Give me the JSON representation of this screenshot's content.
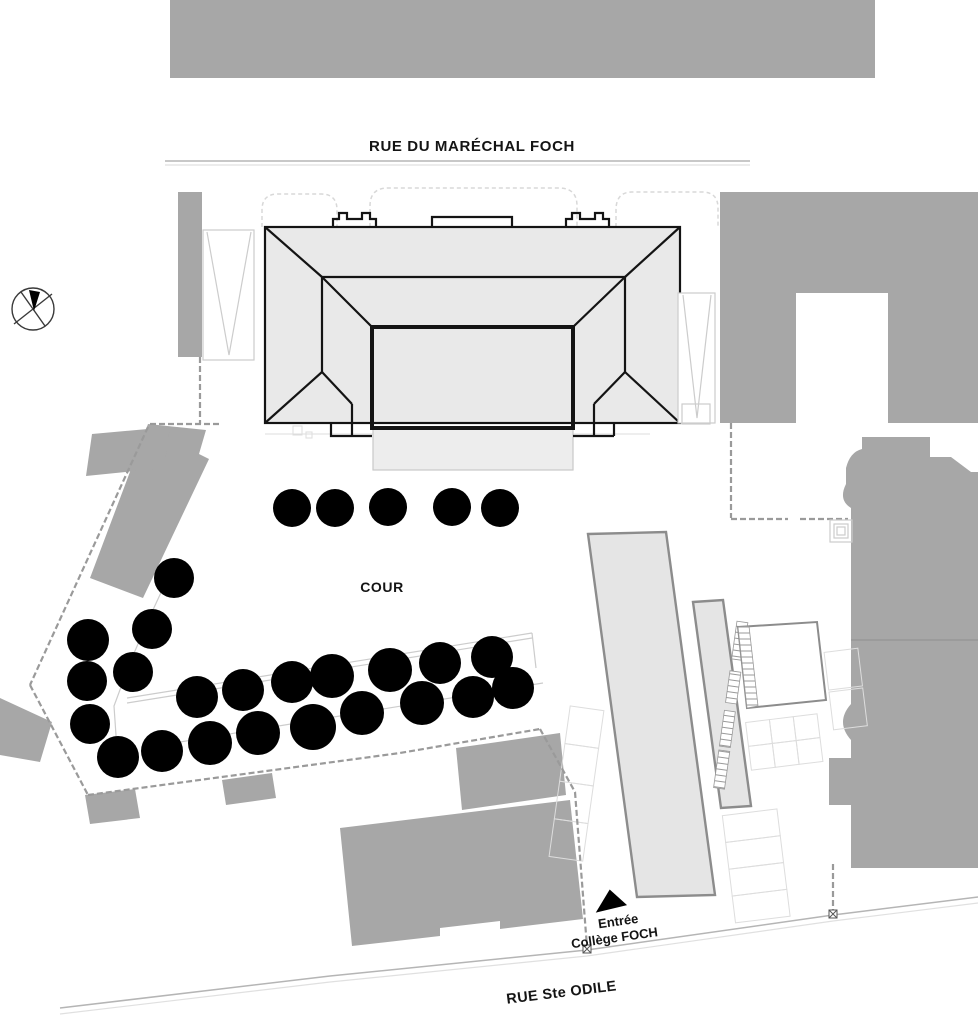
{
  "page": {
    "width": 978,
    "height": 1024,
    "background": "#ffffff"
  },
  "labels": {
    "street_top": "RUE DU MARÉCHAL FOCH",
    "courtyard": "COUR",
    "entrance_line1": "Entrée",
    "entrance_line2": "Collège FOCH",
    "street_bottom": "RUE Ste ODILE"
  },
  "icons": {
    "north_arrow": "compass-north-arrow",
    "entrance_marker": "filled-triangle-up"
  },
  "colors": {
    "bg": "#ffffff",
    "building_solid": "#a7a7a7",
    "roof_fill": "#e9e9e9",
    "roof_line": "#141414",
    "slab_fill": "#e5e5e5",
    "slab_stroke": "#8c8c8c",
    "light_line": "#cccccc",
    "fence_line": "#9a9a9a",
    "street_line": "#b5b5b5",
    "tree_dark": "#1c1c1c",
    "tree_light": "#9c9c9c",
    "label_text": "#141414"
  },
  "trees": [
    {
      "x": 292,
      "y": 508,
      "shade": "light",
      "s": 0.95
    },
    {
      "x": 335,
      "y": 508,
      "shade": "light",
      "s": 0.95
    },
    {
      "x": 388,
      "y": 507,
      "shade": "light",
      "s": 0.95
    },
    {
      "x": 452,
      "y": 507,
      "shade": "light",
      "s": 0.95
    },
    {
      "x": 500,
      "y": 508,
      "shade": "light",
      "s": 0.95
    },
    {
      "x": 174,
      "y": 578,
      "shade": "light",
      "s": 1.0
    },
    {
      "x": 88,
      "y": 640,
      "shade": "dark",
      "s": 1.05
    },
    {
      "x": 152,
      "y": 629,
      "shade": "light",
      "s": 1.0
    },
    {
      "x": 133,
      "y": 672,
      "shade": "light",
      "s": 1.0
    },
    {
      "x": 87,
      "y": 681,
      "shade": "light",
      "s": 1.0
    },
    {
      "x": 90,
      "y": 724,
      "shade": "light",
      "s": 1.0
    },
    {
      "x": 118,
      "y": 757,
      "shade": "dark",
      "s": 1.05
    },
    {
      "x": 162,
      "y": 751,
      "shade": "dark",
      "s": 1.05
    },
    {
      "x": 197,
      "y": 697,
      "shade": "light",
      "s": 1.05
    },
    {
      "x": 243,
      "y": 690,
      "shade": "light",
      "s": 1.05
    },
    {
      "x": 292,
      "y": 682,
      "shade": "light",
      "s": 1.05
    },
    {
      "x": 332,
      "y": 676,
      "shade": "dark",
      "s": 1.1
    },
    {
      "x": 390,
      "y": 670,
      "shade": "light",
      "s": 1.1
    },
    {
      "x": 440,
      "y": 663,
      "shade": "light",
      "s": 1.05
    },
    {
      "x": 492,
      "y": 657,
      "shade": "light",
      "s": 1.05
    },
    {
      "x": 513,
      "y": 688,
      "shade": "dark",
      "s": 1.05
    },
    {
      "x": 210,
      "y": 743,
      "shade": "dark",
      "s": 1.1
    },
    {
      "x": 258,
      "y": 733,
      "shade": "dark",
      "s": 1.1
    },
    {
      "x": 313,
      "y": 727,
      "shade": "dark",
      "s": 1.15
    },
    {
      "x": 362,
      "y": 713,
      "shade": "light",
      "s": 1.1
    },
    {
      "x": 422,
      "y": 703,
      "shade": "light",
      "s": 1.1
    },
    {
      "x": 473,
      "y": 697,
      "shade": "light",
      "s": 1.05
    }
  ]
}
